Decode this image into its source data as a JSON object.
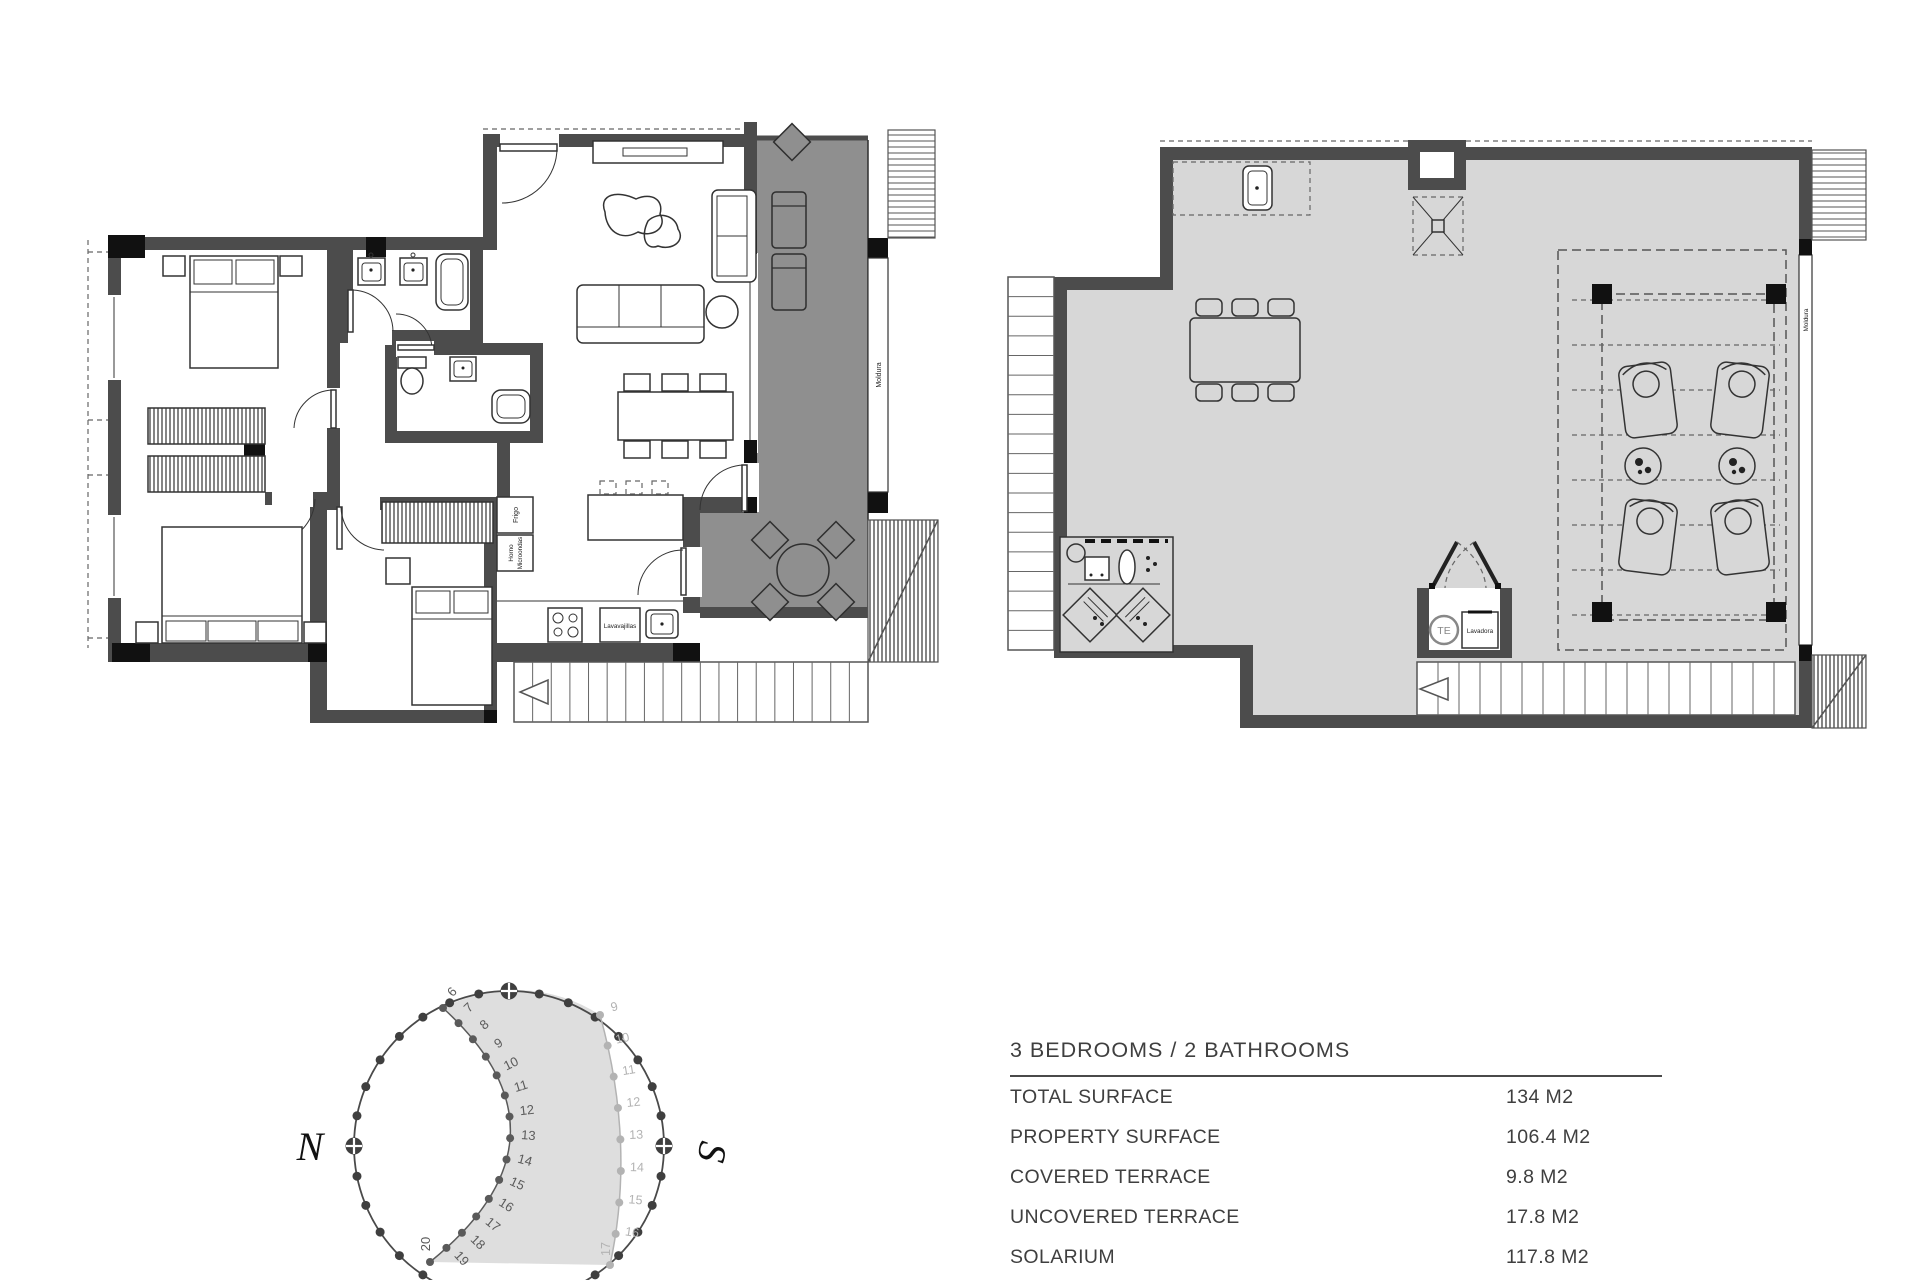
{
  "table": {
    "title": "3 BEDROOMS / 2 BATHROOMS",
    "rows": [
      {
        "label": "TOTAL SURFACE",
        "value": "134 M2"
      },
      {
        "label": "PROPERTY SURFACE",
        "value": "106.4 M2"
      },
      {
        "label": "COVERED TERRACE",
        "value": "9.8 M2"
      },
      {
        "label": "UNCOVERED TERRACE",
        "value": "17.8 M2"
      },
      {
        "label": "SOLARIUM",
        "value": "117.8 M2"
      }
    ]
  },
  "sun": {
    "north": "N",
    "south": "S",
    "inner_hours": [
      "6",
      "7",
      "8",
      "9",
      "10",
      "11",
      "12",
      "13",
      "14",
      "15",
      "16",
      "17",
      "18",
      "19",
      "20"
    ],
    "outer_hours": [
      "9",
      "10",
      "11",
      "12",
      "13",
      "14",
      "15",
      "16",
      "17"
    ]
  },
  "plans": {
    "left": {
      "moldura": "Moldura",
      "frigo": "Frigo",
      "horno": "Horno",
      "microondas": "Microondas",
      "lavavajillas": "Lavavajillas"
    },
    "right": {
      "moldura": "Moldura",
      "te": "TE",
      "lavadora": "Lavadora"
    }
  },
  "colors": {
    "wall": "#4c4c4c",
    "terrace": "#8f8f8f",
    "floor": "#d7d7d7",
    "line": "#333333",
    "text": "#3f3f3f",
    "shade": "#dedede"
  }
}
